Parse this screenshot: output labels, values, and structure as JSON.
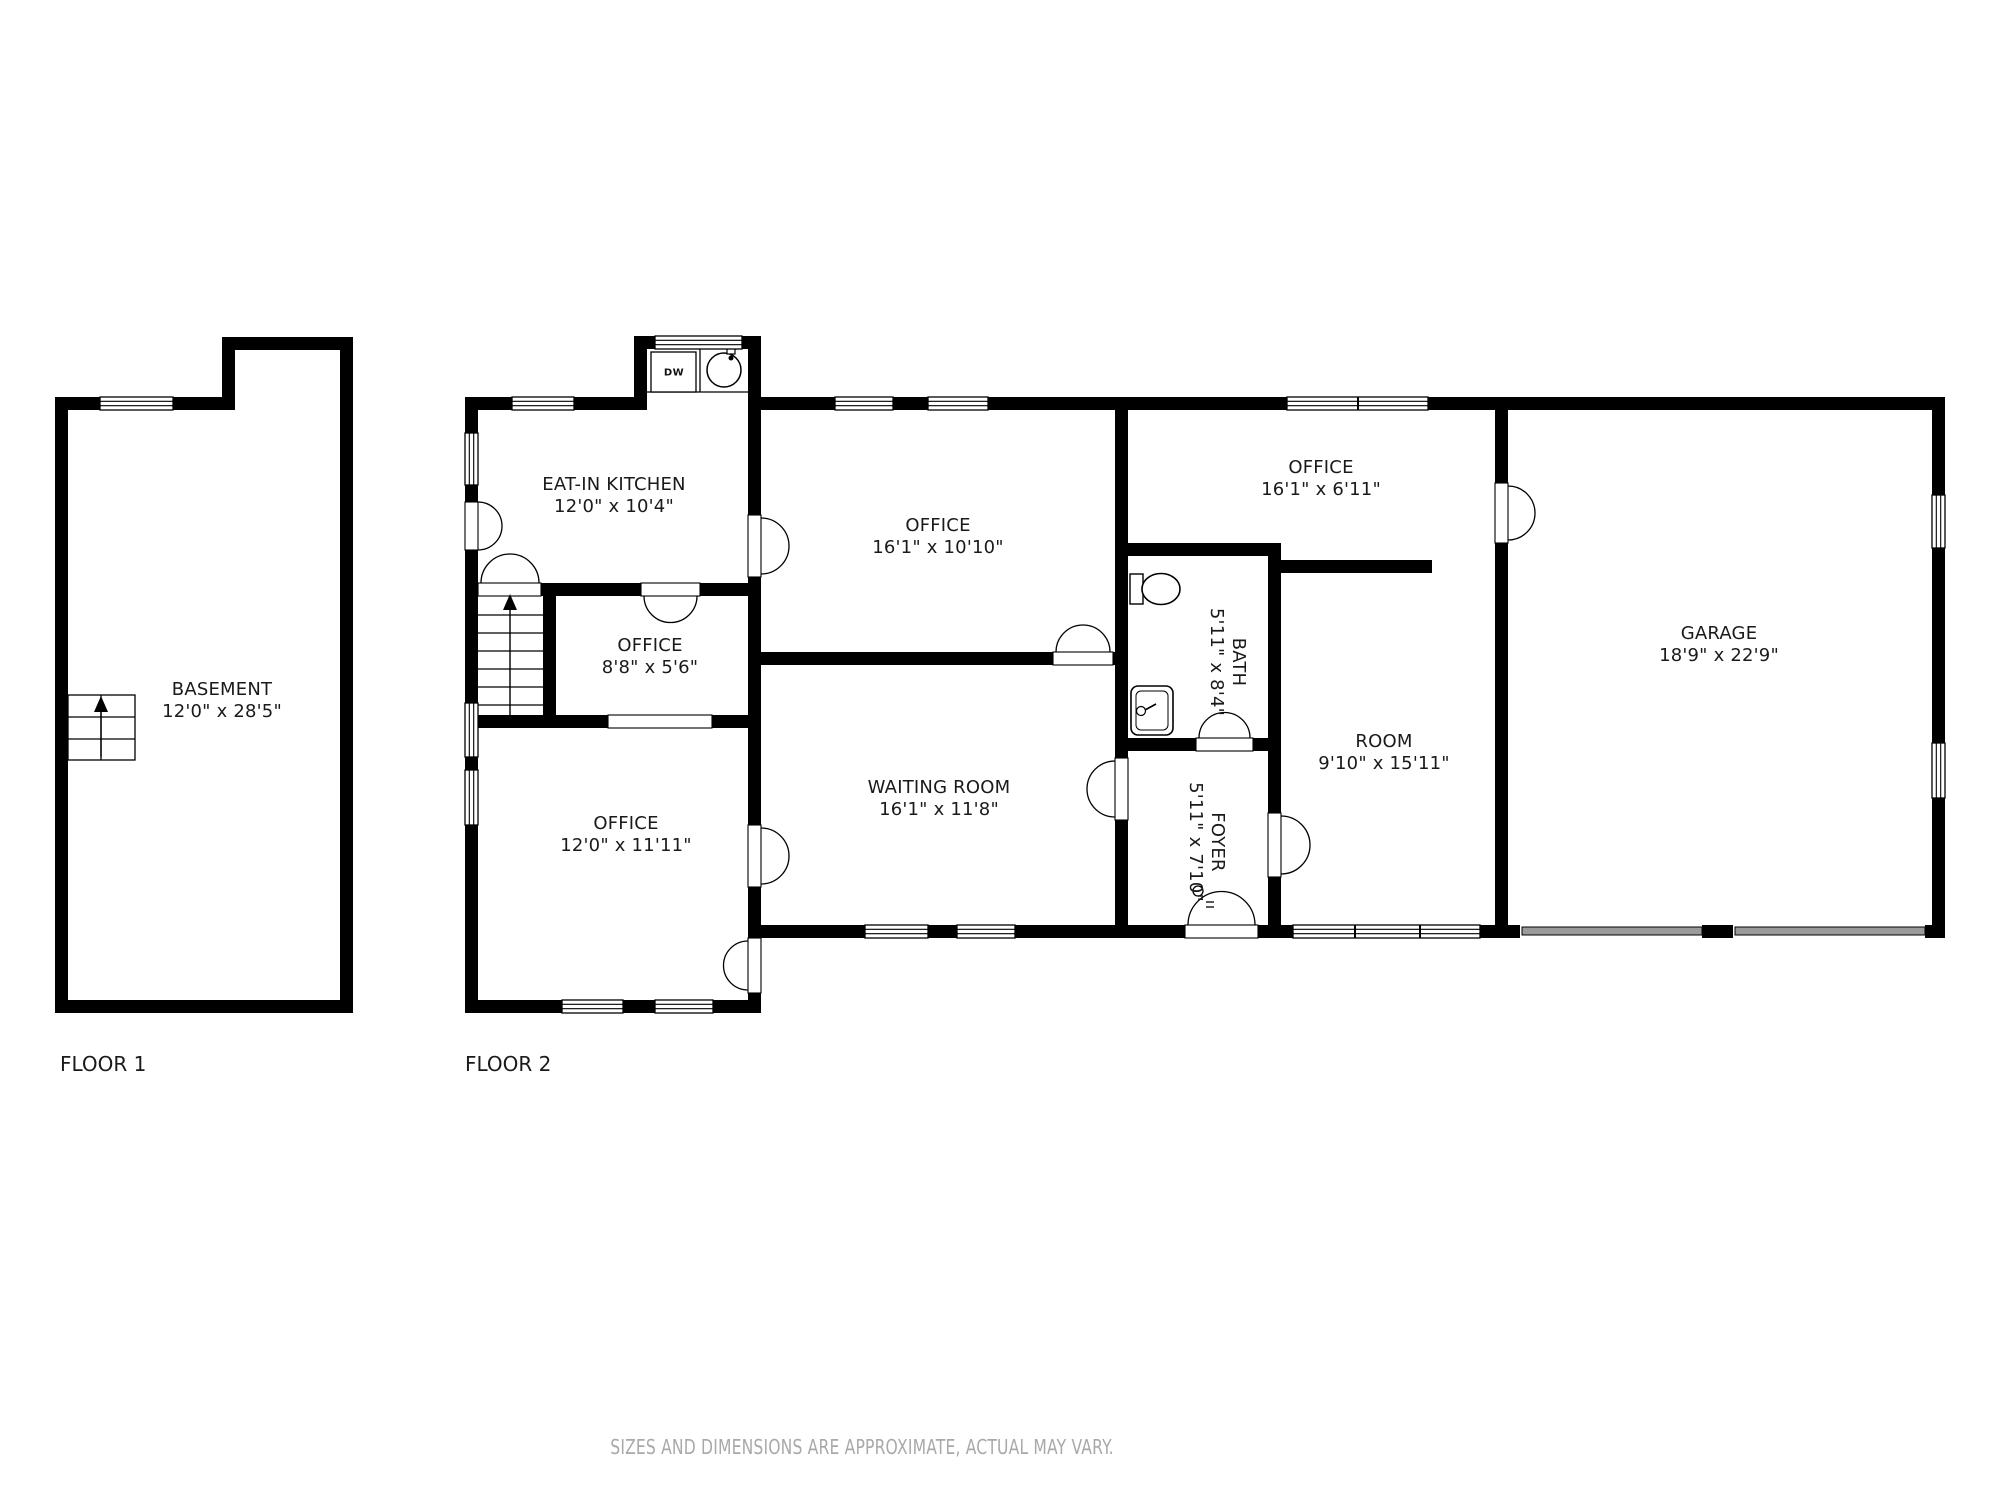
{
  "floor1": {
    "label": "FLOOR 1",
    "basement": {
      "name": "BASEMENT",
      "dims": "12'0\" x 28'5\""
    }
  },
  "floor2": {
    "label": "FLOOR 2",
    "kitchen": {
      "name": "EAT-IN KITCHEN",
      "dims": "12'0\" x 10'4\""
    },
    "office_top": {
      "name": "OFFICE",
      "dims": "16'1\" x 10'10\""
    },
    "office_small": {
      "name": "OFFICE",
      "dims": "8'8\" x 5'6\""
    },
    "office_right": {
      "name": "OFFICE",
      "dims": "16'1\" x 6'11\""
    },
    "office_bottom": {
      "name": "OFFICE",
      "dims": "12'0\" x 11'11\""
    },
    "waiting_room": {
      "name": "WAITING ROOM",
      "dims": "16'1\" x 11'8\""
    },
    "bath": {
      "name": "BATH",
      "dims": "5'11\" x 8'4\""
    },
    "foyer": {
      "name": "FOYER",
      "dims": "5'11\" x 7'10\""
    },
    "room": {
      "name": "ROOM",
      "dims": "9'10\" x 15'11\""
    },
    "garage": {
      "name": "GARAGE",
      "dims": "18'9\" x 22'9\""
    },
    "appliances": {
      "dishwasher": "DW"
    }
  },
  "footer": {
    "disclaimer": "SIZES AND DIMENSIONS ARE APPROXIMATE, ACTUAL MAY VARY."
  },
  "colors": {
    "wall": "#000000",
    "label": "#1a1a1a",
    "disclaimer": "#a9a9a9",
    "garage_door": "#9a9a9a"
  }
}
